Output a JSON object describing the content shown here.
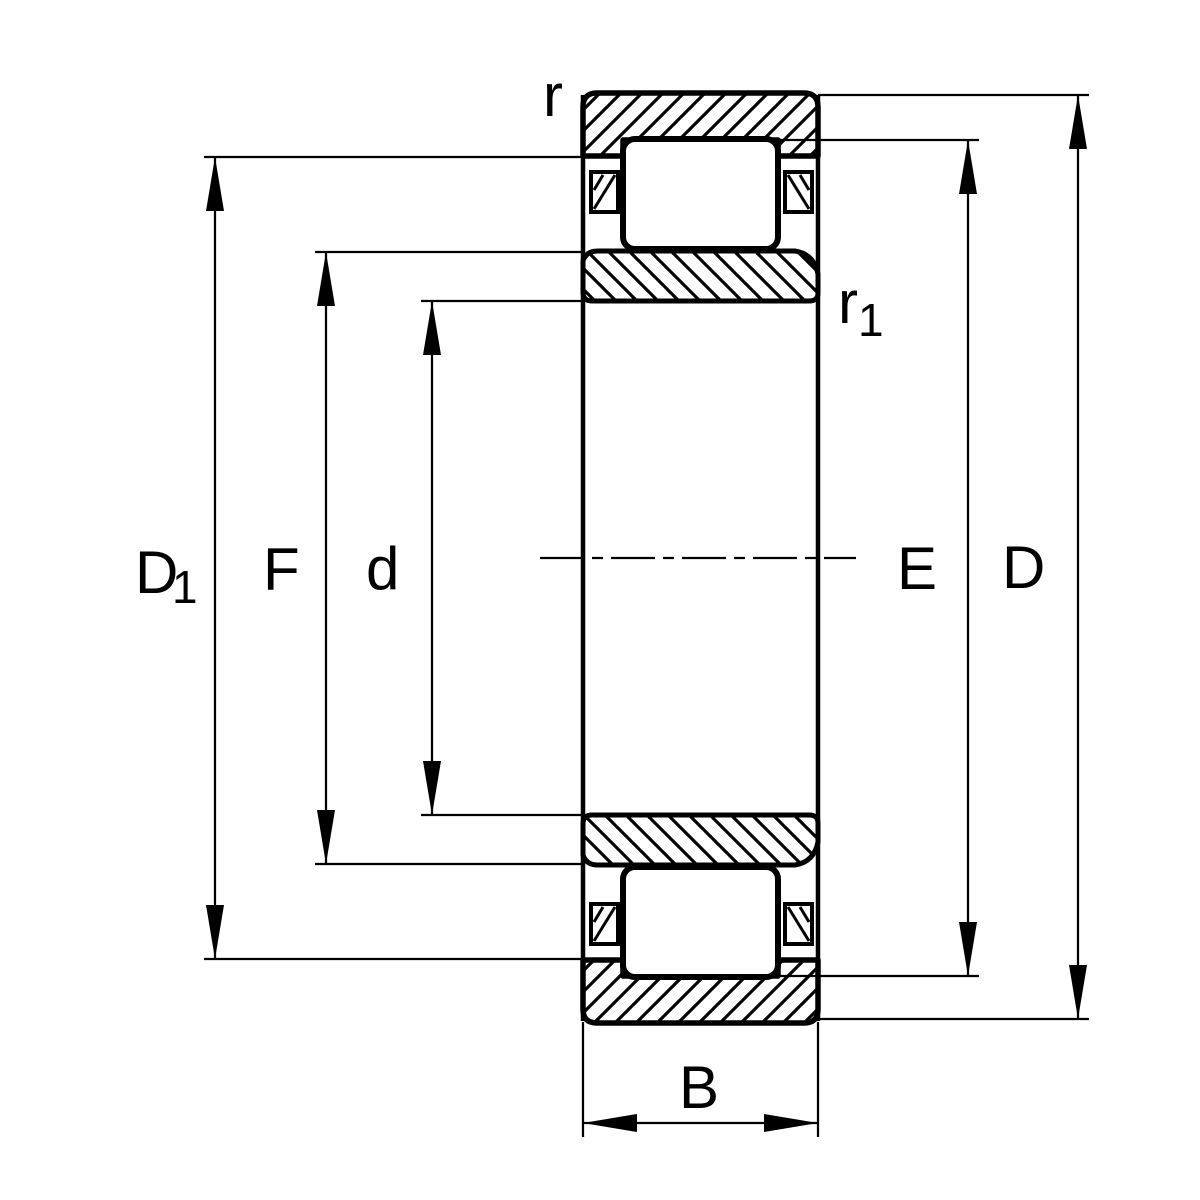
{
  "diagram": {
    "colors": {
      "line": "#000000",
      "background": "#ffffff"
    },
    "labels": {
      "r": "r",
      "r1": {
        "main": "r",
        "sub": "1"
      },
      "D1": {
        "main": "D",
        "sub": "1"
      },
      "F": "F",
      "d": "d",
      "E": "E",
      "D": "D",
      "B": "B"
    }
  }
}
